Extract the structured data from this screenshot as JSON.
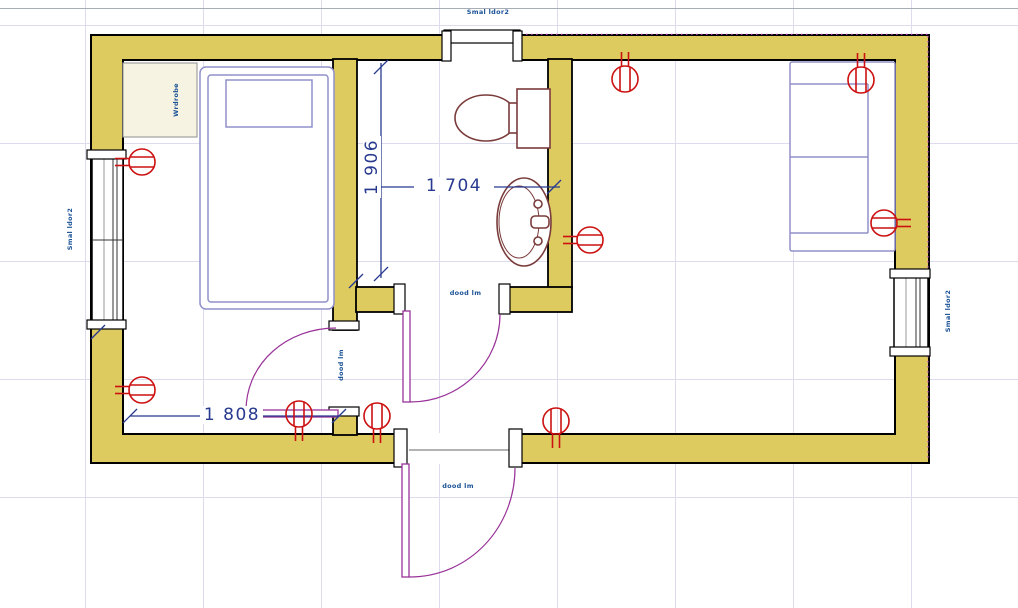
{
  "app": {
    "view": "cad-floor-plan"
  },
  "colors": {
    "wall_fill": "#ddcb5f",
    "wall_outline": "#000000",
    "dimension_blue": "#283a8f",
    "tag_blue": "#1a5296",
    "door_arc_purple": "#993399",
    "fixture_maroon": "#7a3b3b",
    "furniture_periwinkle": "#9090ca",
    "socket_red": "#cc1111",
    "grid": "#dcdcee",
    "wardrobe_fill": "#f7f3e2",
    "magenta_reference": "#cc3fcf"
  },
  "labels": {
    "top_window_tag": "Smal ldor2",
    "left_window_tag": "Smal ldor2",
    "right_window_tag": "Smal ldor2",
    "wardrobe_tag": "Wrdrobe",
    "bathroom_door_tag": "dood lm",
    "bedroom_door_tag": "dood lm",
    "entrance_door_tag": "dood lm"
  },
  "dimensions": {
    "dim_vertical_bathroom": {
      "value": "1 906"
    },
    "dim_horizontal_bathroom": {
      "value": "1 704"
    },
    "dim_horizontal_bedroom": {
      "value": "1 808"
    }
  },
  "objects": {
    "doors": [
      "bedroom-door",
      "bathroom-door",
      "entrance-door"
    ],
    "windows": [
      "left-window",
      "right-window",
      "top-opening"
    ],
    "furniture": [
      "bed",
      "wardrobe",
      "sofa"
    ],
    "fixtures": [
      "toilet",
      "sink"
    ],
    "socket_count": 9
  }
}
